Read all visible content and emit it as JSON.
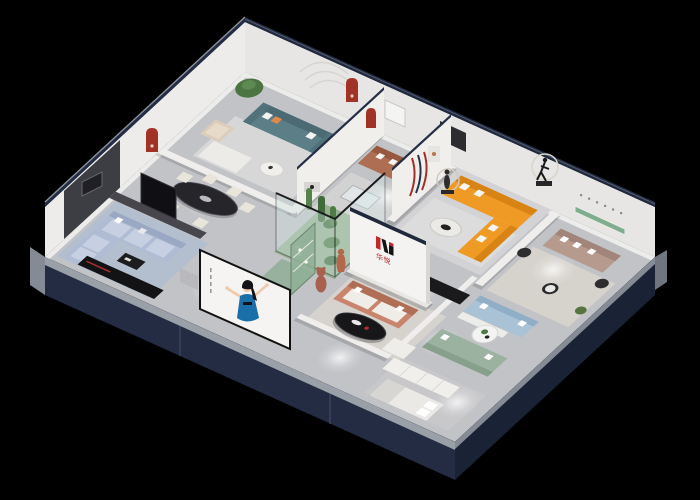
{
  "scene": {
    "description": "3D isometric cutaway rendering of a furniture showroom apartment floating on a black background",
    "background": "#000000"
  },
  "brand": {
    "characters": "华悦",
    "mark_red": "#c1272d",
    "mark_black": "#141414"
  },
  "palette": {
    "exterior_shell_navy": "#202a40",
    "exterior_shell_dark": "#1a2336",
    "wall_top_cap": "#232e46",
    "cut_edge_gray": "#9aa0a8",
    "interior_wall": "#f0efec",
    "floor_gray": "#c2c3c7",
    "atrium_green": "#96b090",
    "sofa_orange": "#f09a26",
    "sofa_teal": "#5c7e87",
    "sofa_salmon": "#c8846c",
    "sofa_brown": "#ad6e54",
    "sofa_mauve": "#b69a8e",
    "sofa_bluegray": "#b0bcd4",
    "sofa_sage": "#9cb2a0",
    "sofa_lightblue": "#a9c2d6",
    "red_arch_niche": "#a33226",
    "green_shelf": "#7fae8e",
    "poster_dress_blue": "#1b6fa8",
    "figure_terracotta": "#b5674d"
  },
  "objects": [
    {
      "name": "teal-sofa-lounge"
    },
    {
      "name": "potted-tree"
    },
    {
      "name": "beige-armchair"
    },
    {
      "name": "black-oval-dining-table"
    },
    {
      "name": "cream-dining-chairs"
    },
    {
      "name": "blue-gray-sectional-sofa"
    },
    {
      "name": "black-media-console"
    },
    {
      "name": "tv-panel"
    },
    {
      "name": "brown-leather-sofa-yellow-pillows"
    },
    {
      "name": "orange-l-shaped-sectional"
    },
    {
      "name": "marble-coffee-table"
    },
    {
      "name": "glass-cactus-atrium"
    },
    {
      "name": "terracotta-figure"
    },
    {
      "name": "brand-logo-wall"
    },
    {
      "name": "salmon-sofa"
    },
    {
      "name": "black-oval-coffee-table"
    },
    {
      "name": "teddy-bear-statue"
    },
    {
      "name": "green-display-cabinet"
    },
    {
      "name": "mauve-sofa"
    },
    {
      "name": "running-man-sculpture-with-ring"
    },
    {
      "name": "ring-sculpture"
    },
    {
      "name": "light-blue-sofa"
    },
    {
      "name": "sage-green-sofa"
    },
    {
      "name": "round-white-coffee-table"
    },
    {
      "name": "red-arch-niches"
    },
    {
      "name": "green-wall-shelf-niche"
    },
    {
      "name": "woman-billboard-poster"
    },
    {
      "name": "white-bedroom-set"
    }
  ]
}
